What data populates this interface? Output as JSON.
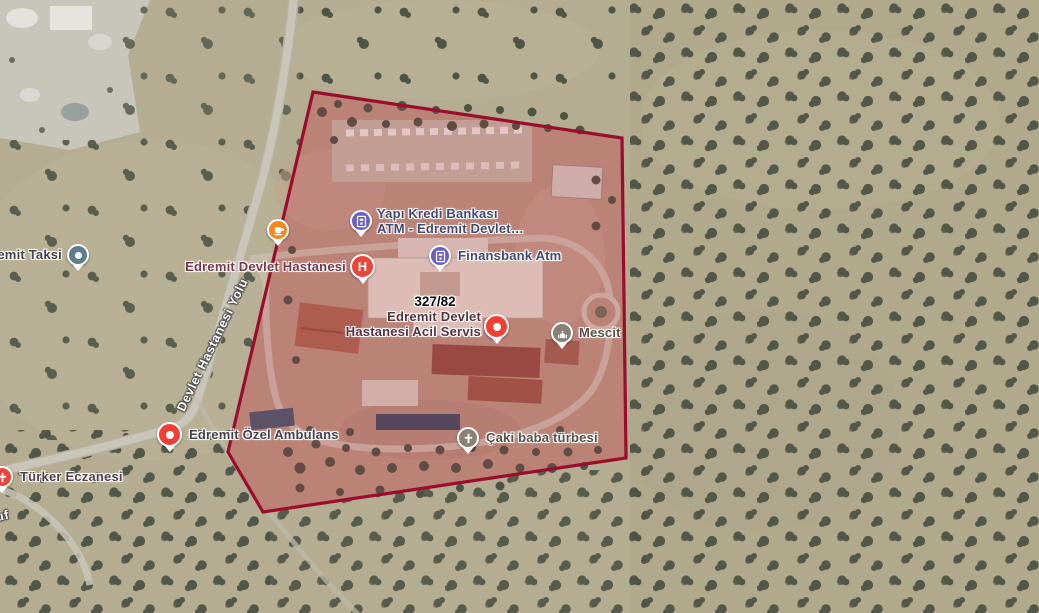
{
  "map": {
    "view_mode": "satellite",
    "parcel": {
      "label": "327/82",
      "stroke_color": "#9b0d2d",
      "fill_tint": "#e02348"
    },
    "roads": [
      {
        "name": "Devlet Hastanesi Yolu"
      },
      {
        "name": "uf"
      }
    ],
    "markers": [
      {
        "id": "edremit-taksi",
        "label": "emit Taksi",
        "color": "#5e7e8b",
        "icon": "dot"
      },
      {
        "id": "cafe-poi",
        "label": "",
        "color": "#f6861f",
        "icon": "cafe-cup"
      },
      {
        "id": "yapi-kredi-atm",
        "lines": [
          "Yapı Kredi Bankası",
          "ATM - Edremit Devlet…"
        ],
        "color": "#6a5fc8",
        "icon": "atm"
      },
      {
        "id": "edremit-devlet-hastanesi",
        "label": "Edremit Devlet Hastanesi",
        "color": "#e8453c",
        "icon": "hospital-h"
      },
      {
        "id": "finansbank-atm",
        "label": "Finansbank Atm",
        "color": "#6a5fc8",
        "icon": "atm"
      },
      {
        "id": "acil-servis",
        "lines": [
          "Edremit Devlet",
          "Hastanesi Acil Servis"
        ],
        "color": "#f23f35",
        "icon": "dot"
      },
      {
        "id": "mescit",
        "label": "Mescit",
        "color": "#8a8174",
        "icon": "mosque"
      },
      {
        "id": "edremit-ozel-ambulans",
        "label": "Edremit Özel Ambulans",
        "color": "#f23f35",
        "icon": "dot"
      },
      {
        "id": "caki-baba-turbesi",
        "label": "Çaki baba türbesi",
        "color": "#8a8174",
        "icon": "tomb-cross"
      },
      {
        "id": "turker-eczanesi",
        "label": "Türker Eczanesi",
        "color": "#e8453c",
        "icon": "pharmacy-cross"
      }
    ],
    "colors": {
      "terrain": "#b4ad91",
      "trees": "#4d5345",
      "road": "#c9c5b9",
      "compound_ground": "#b6937e"
    }
  }
}
